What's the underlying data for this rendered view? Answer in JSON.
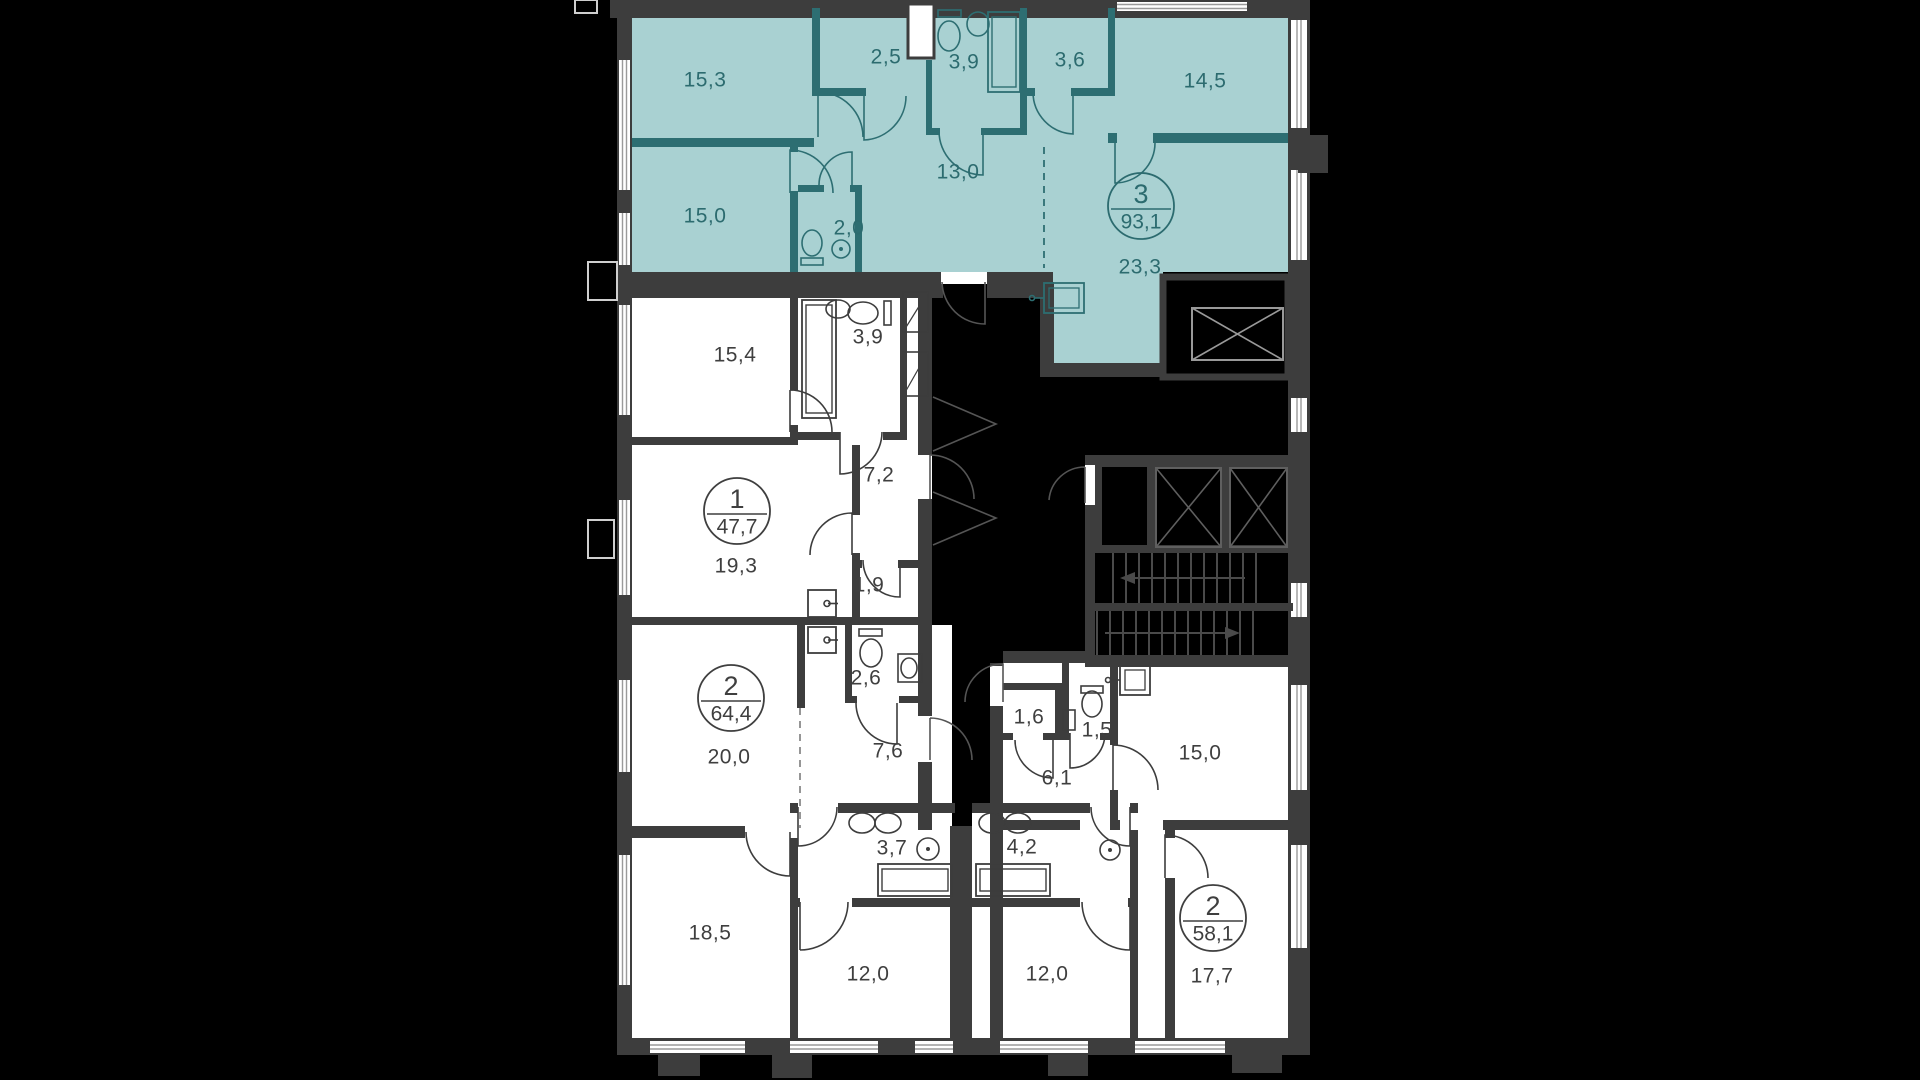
{
  "floor_plan": {
    "apartments": [
      {
        "id": "apt-3",
        "badge": {
          "rooms": "3",
          "area": "93,1"
        },
        "highlighted": true,
        "rooms": [
          {
            "id": "a3_15_3",
            "area": "15,3"
          },
          {
            "id": "a3_2_5",
            "area": "2,5"
          },
          {
            "id": "a3_3_9",
            "area": "3,9"
          },
          {
            "id": "a3_3_6",
            "area": "3,6"
          },
          {
            "id": "a3_14_5",
            "area": "14,5"
          },
          {
            "id": "a3_13_0",
            "area": "13,0"
          },
          {
            "id": "a3_15_0",
            "area": "15,0"
          },
          {
            "id": "a3_2_0",
            "area": "2,0"
          },
          {
            "id": "a3_23_3",
            "area": "23,3"
          }
        ]
      },
      {
        "id": "apt-1",
        "badge": {
          "rooms": "1",
          "area": "47,7"
        },
        "highlighted": false,
        "rooms": [
          {
            "id": "a1_15_4",
            "area": "15,4"
          },
          {
            "id": "a1_3_9",
            "area": "3,9"
          },
          {
            "id": "a1_7_2",
            "area": "7,2"
          },
          {
            "id": "a1_19_3",
            "area": "19,3"
          },
          {
            "id": "a1_1_9",
            "area": "1,9"
          }
        ]
      },
      {
        "id": "apt-2a",
        "badge": {
          "rooms": "2",
          "area": "64,4"
        },
        "highlighted": false,
        "rooms": [
          {
            "id": "a2a_2_6",
            "area": "2,6"
          },
          {
            "id": "a2a_7_6",
            "area": "7,6"
          },
          {
            "id": "a2a_20_0",
            "area": "20,0"
          },
          {
            "id": "a2a_18_5",
            "area": "18,5"
          },
          {
            "id": "a2a_3_7",
            "area": "3,7"
          },
          {
            "id": "a2a_12_0",
            "area": "12,0"
          }
        ]
      },
      {
        "id": "apt-2b",
        "badge": {
          "rooms": "2",
          "area": "58,1"
        },
        "highlighted": false,
        "rooms": [
          {
            "id": "a2b_1_6",
            "area": "1,6"
          },
          {
            "id": "a2b_1_5",
            "area": "1,5"
          },
          {
            "id": "a2b_15_0",
            "area": "15,0"
          },
          {
            "id": "a2b_6_1",
            "area": "6,1"
          },
          {
            "id": "a2b_4_2",
            "area": "4,2"
          },
          {
            "id": "a2b_12_0",
            "area": "12,0"
          },
          {
            "id": "a2b_17_7",
            "area": "17,7"
          }
        ]
      }
    ],
    "colors": {
      "background": "#000000",
      "wall": "#3d3d3d",
      "highlight_fill": "#a9d1d2",
      "highlight_line": "#2d6e72",
      "room_fill": "#ffffff",
      "label": "#3f3f3f"
    }
  }
}
